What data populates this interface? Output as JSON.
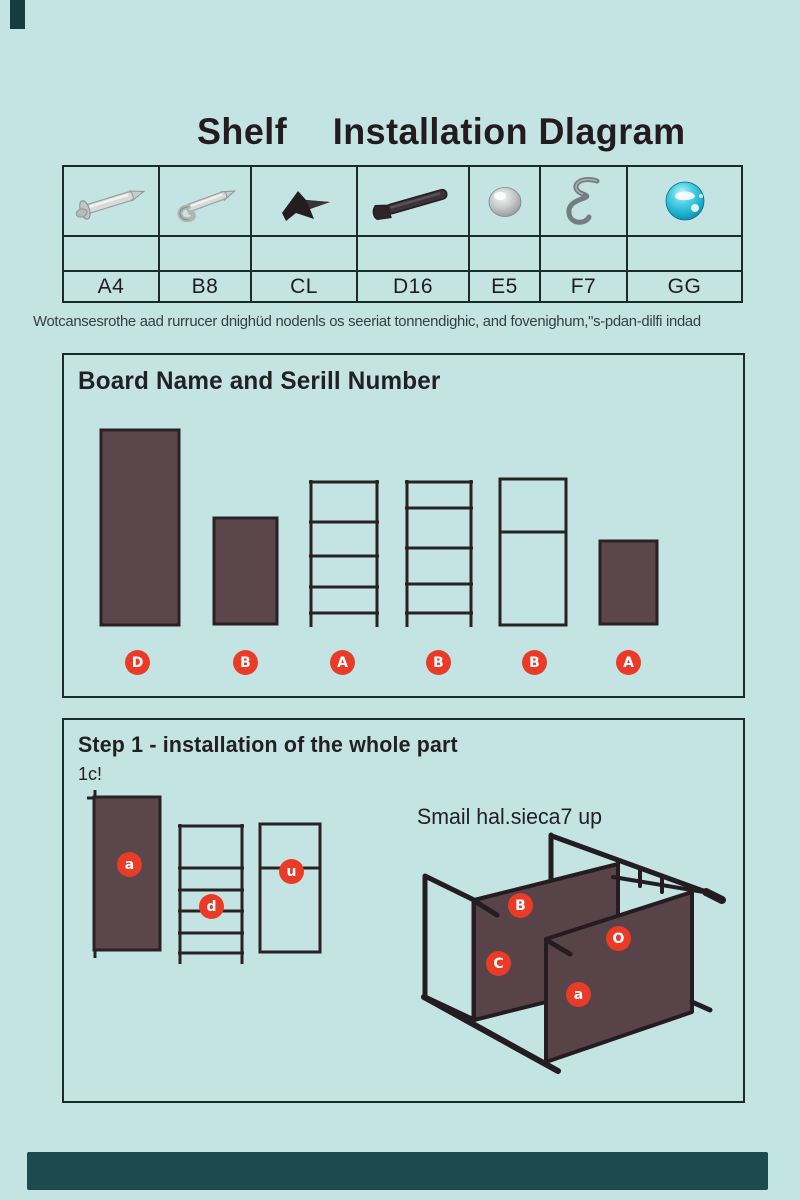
{
  "page_title": {
    "word1": "Shelf",
    "word2": "Installation Dlagram"
  },
  "parts_table": {
    "parts": [
      {
        "label": "A4",
        "icon": "silver-screw-icon"
      },
      {
        "label": "B8",
        "icon": "silver-hook-screw-icon"
      },
      {
        "label": "CL",
        "icon": "black-clip-icon"
      },
      {
        "label": "D16",
        "icon": "dark-bolt-icon"
      },
      {
        "label": "E5",
        "icon": "silver-ball-icon"
      },
      {
        "label": "F7",
        "icon": "s-hook-icon"
      },
      {
        "label": "GG",
        "icon": "teal-ball-icon"
      }
    ]
  },
  "notes_line": "Wotcansesrothe aad rurrucer dnighüd nodenls os seeriat tonnendighic, and fovenighum,\"s-pdan-dilfi indad",
  "board_section": {
    "title": "Board Name and Serill Number",
    "badges": [
      "D",
      "B",
      "A",
      "B",
      "B",
      "A"
    ]
  },
  "step_section": {
    "title": "Step 1 - installation of the whole part",
    "subtitle": "1c!",
    "caption": "Smail hal.sieca7 up",
    "left_badges": [
      "a",
      "d",
      "u"
    ],
    "iso_badges": [
      "B",
      "C",
      "O",
      "a"
    ]
  },
  "colors": {
    "background": "#c3e4e2",
    "board_fill": "#5b464c",
    "line_dark": "#2a2125",
    "badge_red": "#e93b27",
    "accent_bar": "#1d4a4e"
  }
}
